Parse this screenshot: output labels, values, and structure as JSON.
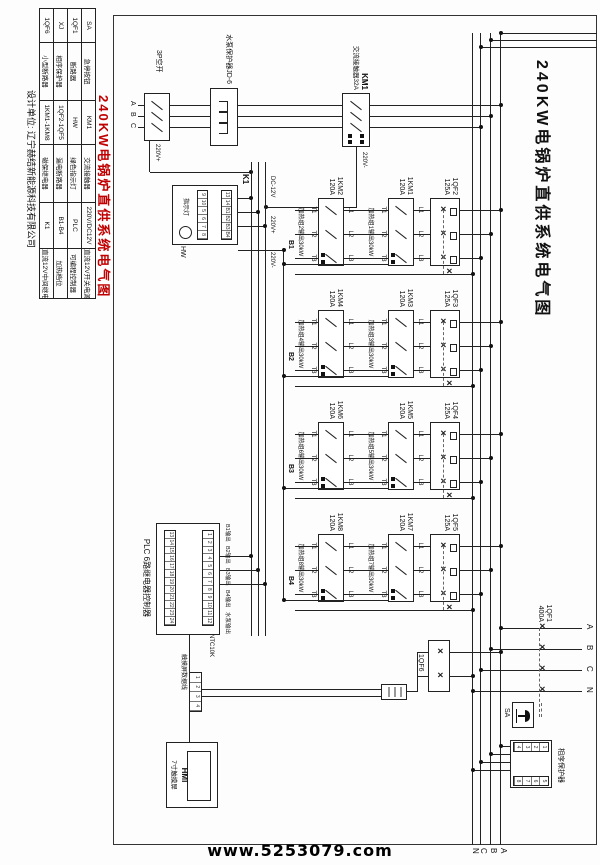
{
  "watermark": "www.5253079.com",
  "title": "240KW电锅炉直供系统电气图",
  "legend": {
    "designer": "设计单位: 辽宁赫结新能源科技有限公司",
    "rows": [
      {
        "c1": "SA",
        "n1": "急停按钮",
        "c2": "KM1",
        "n2": "交流接触器",
        "c3": "220V/DC12V",
        "n3": "直流12V开关电源"
      },
      {
        "c1": "1QF1",
        "n1": "断路器",
        "c2": "HW",
        "n2": "绿色指示灯",
        "c3": "PLC",
        "n3": "可编程控制器"
      },
      {
        "c1": "XJ",
        "n1": "相序保护器",
        "c2": "1QF2-1QF5",
        "n2": "漏电断路器",
        "c3": "B1-B4",
        "n3": "加热档位"
      },
      {
        "c1": "1QF6",
        "n1": "小型断路器",
        "c2": "1KM1-1KM8",
        "n2": "磁保继电器",
        "c3": "K1",
        "n3": "直流12V中间继电器"
      }
    ]
  },
  "bus": {
    "a": "A",
    "b": "B",
    "c": "C",
    "n": "N"
  },
  "main_breaker": {
    "name": "1QF1",
    "rating": "400A",
    "t_a": "A",
    "t_b": "B",
    "t_c": "C",
    "t_n": "N"
  },
  "estop": {
    "name": "SA"
  },
  "xj": {
    "label": "相序保护器",
    "t_left": [
      "1",
      "2",
      "3",
      "4"
    ],
    "t_right": [
      "5",
      "6",
      "7",
      "8"
    ]
  },
  "pump": {
    "contactor": "KM1",
    "contactor_desc": "交流接触器32A",
    "protector": "水泵保护器JD-6",
    "breaker": "3P空开",
    "out_a": "A",
    "out_b": "B",
    "out_c": "C",
    "tap_pos": "220V+",
    "coil_neg": "220V-"
  },
  "control": {
    "dc": "DC-12V",
    "pos": "220V+",
    "neg": "220V-"
  },
  "k1": {
    "name": "K1",
    "hw": "HW",
    "light": "指示灯",
    "strip_top": [
      "13",
      "14",
      "B1",
      "B2",
      "B3",
      "B4"
    ],
    "strip_bot": [
      "9",
      "10",
      "5",
      "6",
      "7",
      "8"
    ]
  },
  "groups": [
    {
      "qf": "1QF2",
      "qf_rating": "125A",
      "km_upper": "1KM1",
      "km_lower": "1KM2",
      "km_rating": "120A",
      "out_upper": "加热组1输出30kW",
      "out_lower": "加热组2输出30kW",
      "b": "B1",
      "l": [
        "L1",
        "L2",
        "L3"
      ],
      "t": [
        "T1",
        "T2",
        "T3"
      ]
    },
    {
      "qf": "1QF3",
      "qf_rating": "125A",
      "km_upper": "1KM3",
      "km_lower": "1KM4",
      "km_rating": "120A",
      "out_upper": "加热组3输出30kW",
      "out_lower": "加热组4输出30kW",
      "b": "B2",
      "l": [
        "L1",
        "L2",
        "L3"
      ],
      "t": [
        "T1",
        "T2",
        "T3"
      ]
    },
    {
      "qf": "1QF4",
      "qf_rating": "125A",
      "km_upper": "1KM5",
      "km_lower": "1KM6",
      "km_rating": "120A",
      "out_upper": "加热组5输出30kW",
      "out_lower": "加热组6输出30kW",
      "b": "B3",
      "l": [
        "L1",
        "L2",
        "L3"
      ],
      "t": [
        "T1",
        "T2",
        "T3"
      ]
    },
    {
      "qf": "1QF5",
      "qf_rating": "125A",
      "km_upper": "1KM7",
      "km_lower": "1KM8",
      "km_rating": "120A",
      "out_upper": "加热组7输出30kW",
      "out_lower": "加热组8输出30kW",
      "b": "B4",
      "l": [
        "L1",
        "L2",
        "L3"
      ],
      "t": [
        "T1",
        "T2",
        "T3"
      ]
    }
  ],
  "qf6": {
    "name": "1QF6"
  },
  "plc": {
    "label": "PLC 6路继电器控制器",
    "outputs": [
      "B1输出",
      "B2输出",
      "B3输出",
      "B4输出",
      "水泵输出"
    ],
    "sensor": "NTC10K",
    "sensor_cells": [
      "1",
      "2",
      "3",
      "4"
    ],
    "strip_top": [
      "1",
      "2",
      "3",
      "4",
      "5",
      "6",
      "7",
      "8",
      "9",
      "10",
      "11",
      "12"
    ],
    "strip_bot": [
      "13",
      "14",
      "15",
      "16",
      "17",
      "18",
      "19",
      "20",
      "21",
      "22",
      "23",
      "24"
    ]
  },
  "hmi": {
    "name": "HMI",
    "label": "7寸触摸屏",
    "cable": "触摸屏数据线"
  }
}
